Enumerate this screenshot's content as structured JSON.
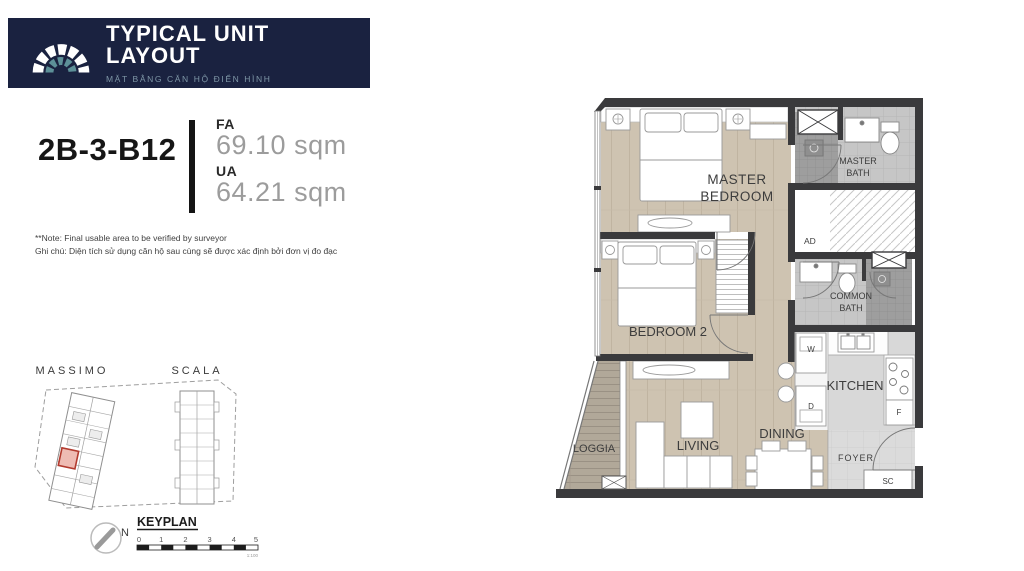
{
  "header": {
    "title": "TYPICAL UNIT LAYOUT",
    "subtitle": "MẶT BẰNG CĂN HỘ ĐIỂN HÌNH"
  },
  "unit": {
    "code": "2B-3-B12",
    "fa_label": "FA",
    "fa_value": "69.10 sqm",
    "ua_label": "UA",
    "ua_value": "64.21 sqm"
  },
  "notes": {
    "line1": "**Note: Final usable area to be verified by surveyor",
    "line2": "Ghi chú: Diện tích sử dụng căn hộ sau cùng sẽ được xác định bởi đơn vị đo đạc"
  },
  "keyplan": {
    "building_left": "MASSIMO",
    "building_right": "SCALA",
    "north_label": "N",
    "title": "KEYPLAN",
    "scale_ticks": [
      "0",
      "1",
      "2",
      "3",
      "4",
      "5"
    ],
    "scale_caption": "1:100"
  },
  "floorplan": {
    "rooms": {
      "master_bedroom": [
        "MASTER",
        "BEDROOM"
      ],
      "master_bath": [
        "MASTER",
        "BATH"
      ],
      "common_bath": [
        "COMMON",
        "BATH"
      ],
      "bedroom2": "BEDROOM 2",
      "kitchen": "KITCHEN",
      "living": "LIVING",
      "dining": "DINING",
      "loggia": "LOGGIA",
      "foyer": "FOYER"
    },
    "tags": {
      "ad": "AD",
      "washer": "W",
      "dryer": "D",
      "fridge": "F",
      "shoe_cabinet": "SC"
    }
  },
  "colors": {
    "navy": "#1a2240",
    "teal": "#5d9098",
    "wall": "#3a3a3c",
    "wood": "#cec3b1",
    "unit_highlight": "#b23a2e"
  }
}
